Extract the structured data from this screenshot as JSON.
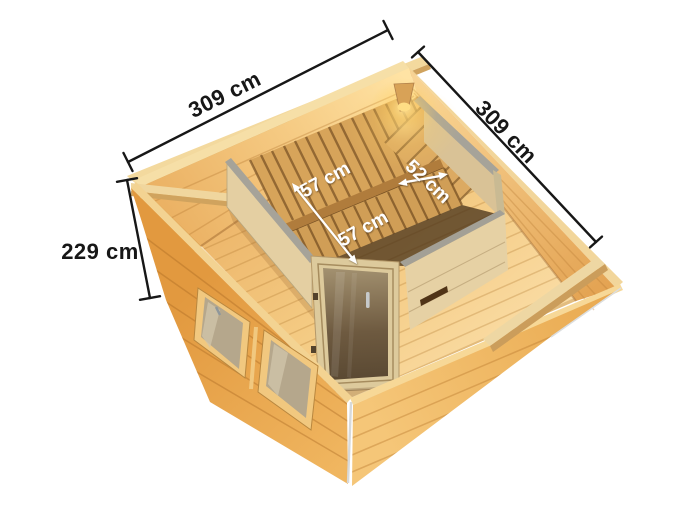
{
  "diagram": {
    "dimensions": {
      "back_width": "309 cm",
      "right_depth": "309 cm",
      "wall_height": "229 cm"
    },
    "bench_dimensions": {
      "upper_bench_depth": "57 cm",
      "side_bench_width": "52 cm",
      "lower_bench_depth": "57 cm"
    },
    "colors": {
      "background": "#ffffff",
      "dimension_line": "#171717",
      "dimension_text": "#171717",
      "bench_label_text": "#ffffff",
      "wood_exterior": "#e8a44c",
      "wood_interior_wall": "#f4c77f",
      "wood_floor": "#f4ca82",
      "sauna_wall_pale": "#e6d1a4",
      "sauna_wall_cap": "#a6a399",
      "door_glass_bronze": "#6e5a40",
      "window_glass": "#b5a78c",
      "bench_wood": "#d7a45a",
      "lamp_glow": "#ffd98a"
    }
  }
}
